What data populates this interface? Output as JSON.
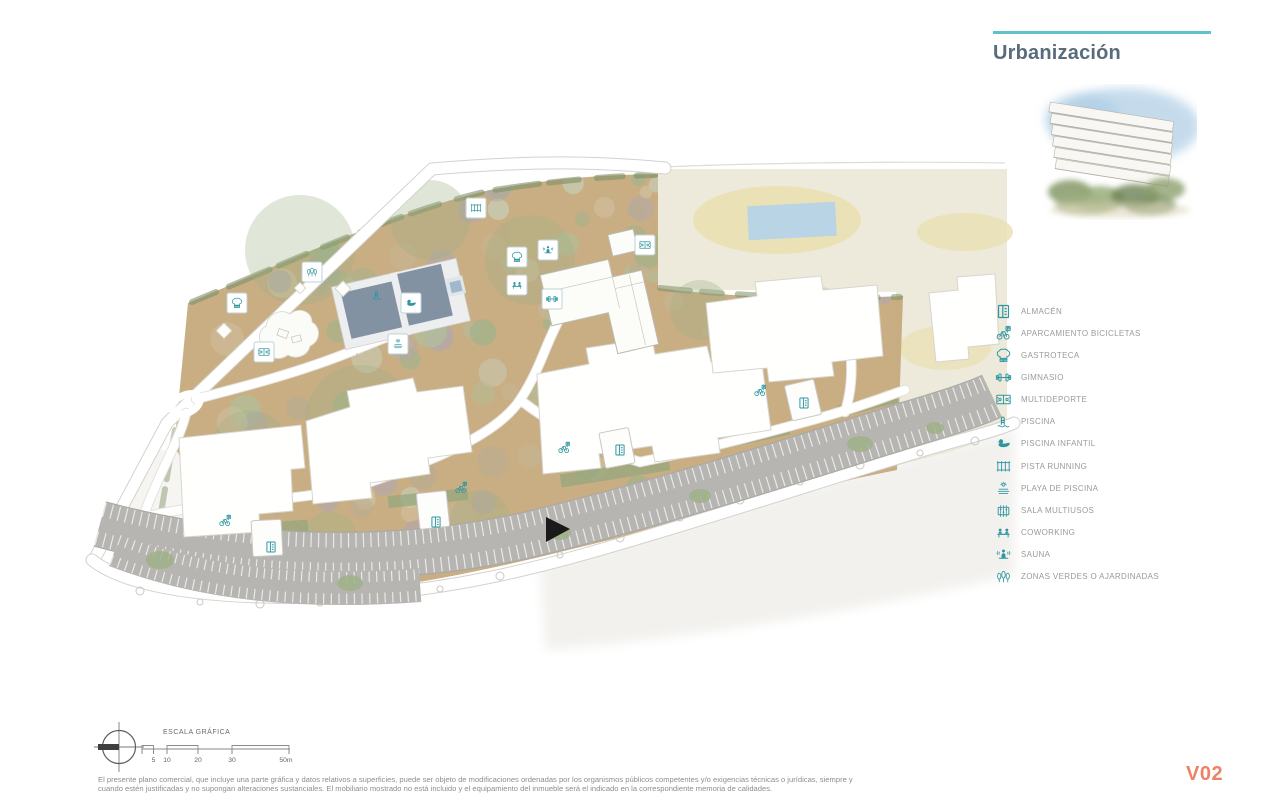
{
  "header": {
    "title": "Urbanización"
  },
  "legend": {
    "items": [
      {
        "icon": "almacen",
        "label": "ALMACÉN"
      },
      {
        "icon": "aparcamiento-bicicletas",
        "label": "APARCAMIENTO BICICLETAS"
      },
      {
        "icon": "gastroteca",
        "label": "GASTROTECA"
      },
      {
        "icon": "gimnasio",
        "label": "GIMNASIO"
      },
      {
        "icon": "multideporte",
        "label": "MULTIDEPORTE"
      },
      {
        "icon": "piscina",
        "label": "PISCINA"
      },
      {
        "icon": "piscina-infantil",
        "label": "PISCINA INFANTIL"
      },
      {
        "icon": "pista-running",
        "label": "PISTA RUNNING"
      },
      {
        "icon": "playa-de-piscina",
        "label": "PLAYA DE PISCINA"
      },
      {
        "icon": "sala-multiusos",
        "label": "SALA MULTIUSOS"
      },
      {
        "icon": "coworking",
        "label": "COWORKING"
      },
      {
        "icon": "sauna",
        "label": "SAUNA"
      },
      {
        "icon": "zonas-verdes",
        "label": "ZONAS VERDES O AJARDINADAS"
      }
    ]
  },
  "map": {
    "markers": [
      {
        "icon": "pista-running",
        "x": 476,
        "y": 208,
        "boxed": true
      },
      {
        "icon": "zonas-verdes",
        "x": 312,
        "y": 272,
        "boxed": true
      },
      {
        "icon": "gastroteca",
        "x": 237,
        "y": 303,
        "boxed": true
      },
      {
        "icon": "multideporte",
        "x": 264,
        "y": 352,
        "boxed": true
      },
      {
        "icon": "piscina",
        "x": 377,
        "y": 295,
        "boxed": false
      },
      {
        "icon": "piscina-infantil",
        "x": 411,
        "y": 303,
        "boxed": true
      },
      {
        "icon": "playa-de-piscina",
        "x": 398,
        "y": 344,
        "boxed": true
      },
      {
        "icon": "gastroteca",
        "x": 517,
        "y": 257,
        "boxed": true
      },
      {
        "icon": "sauna",
        "x": 548,
        "y": 250,
        "boxed": true
      },
      {
        "icon": "coworking",
        "x": 517,
        "y": 285,
        "boxed": true
      },
      {
        "icon": "gimnasio",
        "x": 552,
        "y": 299,
        "boxed": true
      },
      {
        "icon": "multideporte",
        "x": 645,
        "y": 245,
        "boxed": true
      },
      {
        "icon": "almacen",
        "x": 271,
        "y": 547,
        "boxed": false
      },
      {
        "icon": "almacen",
        "x": 436,
        "y": 522,
        "boxed": false
      },
      {
        "icon": "almacen",
        "x": 620,
        "y": 450,
        "boxed": false
      },
      {
        "icon": "almacen",
        "x": 804,
        "y": 403,
        "boxed": false
      },
      {
        "icon": "aparcamiento-bicicletas",
        "x": 225,
        "y": 521,
        "boxed": false
      },
      {
        "icon": "aparcamiento-bicicletas",
        "x": 461,
        "y": 488,
        "boxed": false
      },
      {
        "icon": "aparcamiento-bicicletas",
        "x": 564,
        "y": 448,
        "boxed": false
      },
      {
        "icon": "aparcamiento-bicicletas",
        "x": 760,
        "y": 391,
        "boxed": false
      }
    ]
  },
  "scale": {
    "title": "ESCALA GRÁFICA",
    "ticks": [
      "5",
      "10",
      "20",
      "30",
      "50m"
    ]
  },
  "footer": {
    "disclaimer_line1": "El presente plano comercial, que incluye una parte gráfica y datos relativos a superficies, puede ser objeto de modificaciones ordenadas por los organismos públicos competentes y/o exigencias técnicas o jurídicas, siempre y",
    "disclaimer_line2": "cuando estén justificadas y no supongan alteraciones sustanciales. El mobiliario mostrado no está incluido y el equipamiento del inmueble será el indicado en la correspondiente memoria de calidades.",
    "version": "V02"
  },
  "colors": {
    "accent_teal": "#2f96a1",
    "rule_teal": "#5ec1cb",
    "title_slate": "#5a6b7c",
    "version_coral": "#ee8266",
    "ground_tan": "#c6aa7d",
    "neighbor_beige": "#edeadb",
    "parking_gray": "#b6b5b1",
    "pool_slate": "#8292a3"
  }
}
